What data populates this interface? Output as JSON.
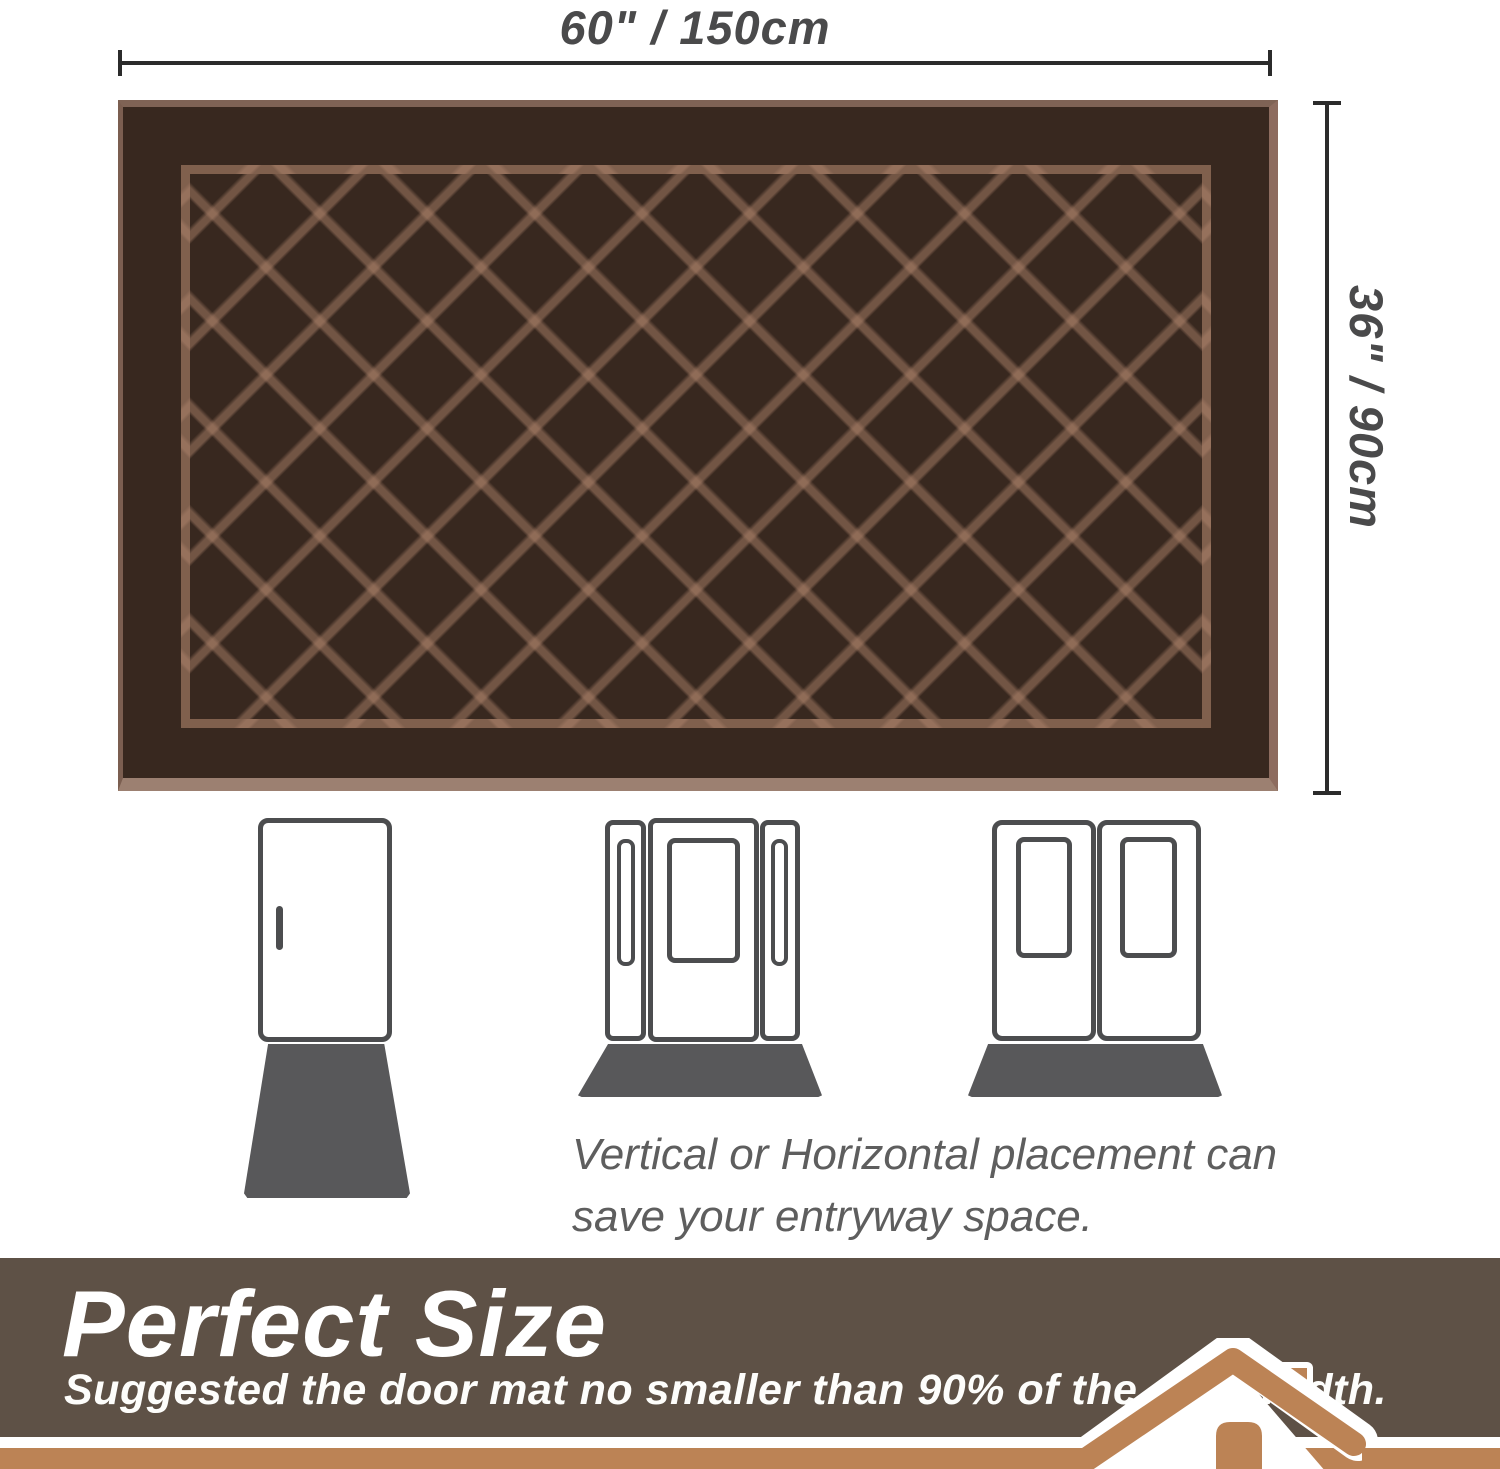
{
  "dimensions": {
    "width_label": "60\" / 150cm",
    "height_label": "36\" / 90cm",
    "line_color": "#2b2b2b",
    "text_color": "#4a4a4b"
  },
  "mat_illustration": {
    "pattern": "diamond-lattice",
    "base_color": "#38281f",
    "lattice_color": "#a87c62",
    "bottom_edge_color": "#9c8071"
  },
  "placement_section": {
    "caption_line1": "Vertical or Horizontal placement can",
    "caption_line2": "save your entryway space.",
    "door_icons": [
      "single-door",
      "door-with-sidelights",
      "double-door"
    ],
    "door_outline_color": "#4c4d4f",
    "mat_fill_color": "#58585a"
  },
  "banner": {
    "title": "Perfect Size",
    "subtitle": "Suggested the door mat no smaller than 90% of the door width.",
    "background_color": "#5e5146",
    "text_color": "#ffffff",
    "accent_color": "#bc8355"
  }
}
